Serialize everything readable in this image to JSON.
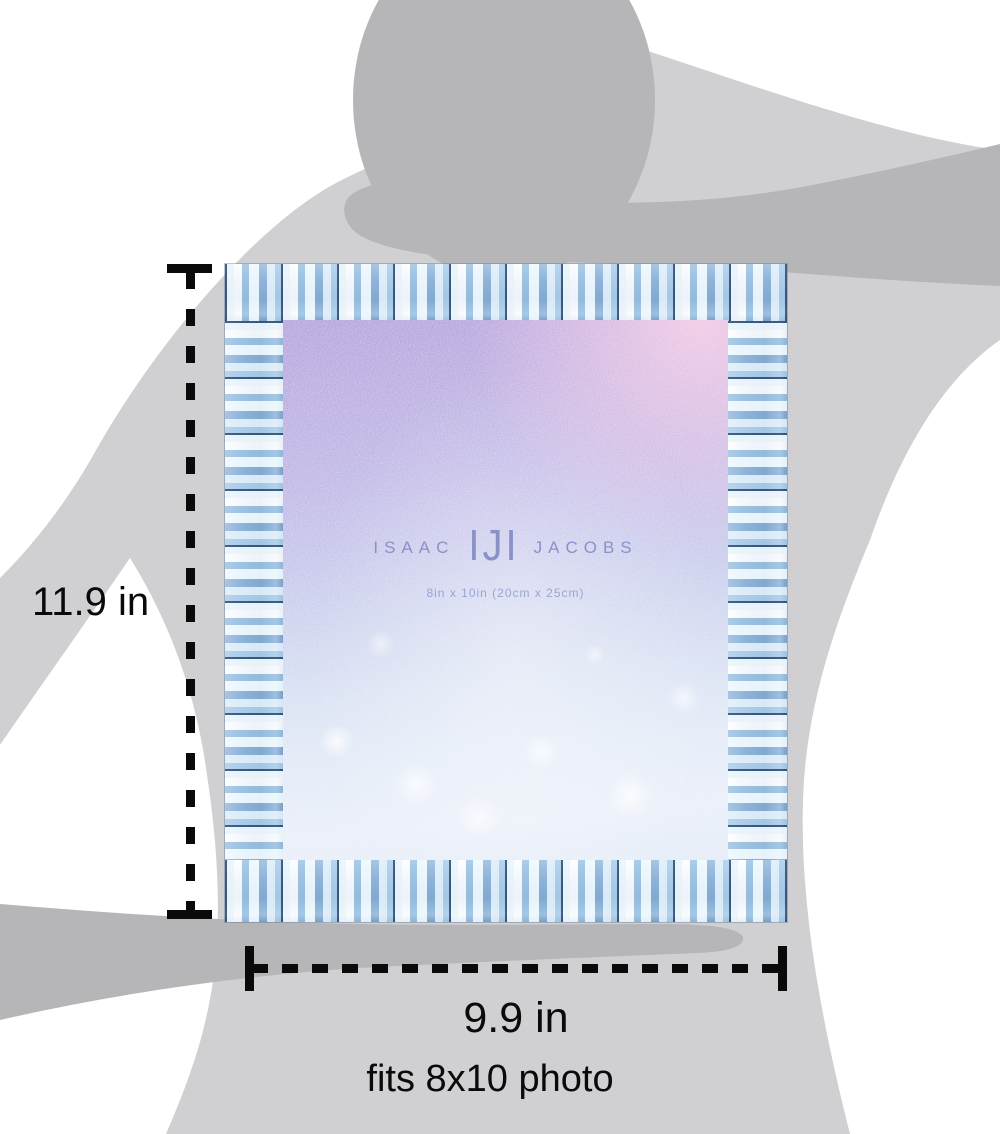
{
  "annotations": {
    "height_label": "11.9 in",
    "width_label": "9.9 in",
    "fits_label": "fits 8x10 photo"
  },
  "frame": {
    "brand_left": "ISAAC",
    "brand_monogram": "IJI",
    "brand_right": "JACOBS",
    "insert_size": "8in x 10in (20cm x 25cm)"
  },
  "colors": {
    "silhouette_body": "#d0d0d2",
    "silhouette_dark": "#b6b6b8",
    "annotation_black": "#0a0a0a",
    "jewel_light": "#dcebf7",
    "jewel_mid": "#a9c4e0",
    "jewel_seam": "#41618c",
    "photo_top_purple": "#b2a0dc",
    "photo_top_pink": "#f3c9e5",
    "photo_bottom_blue": "#e8eef9",
    "logo_blue": "#8892c8"
  }
}
